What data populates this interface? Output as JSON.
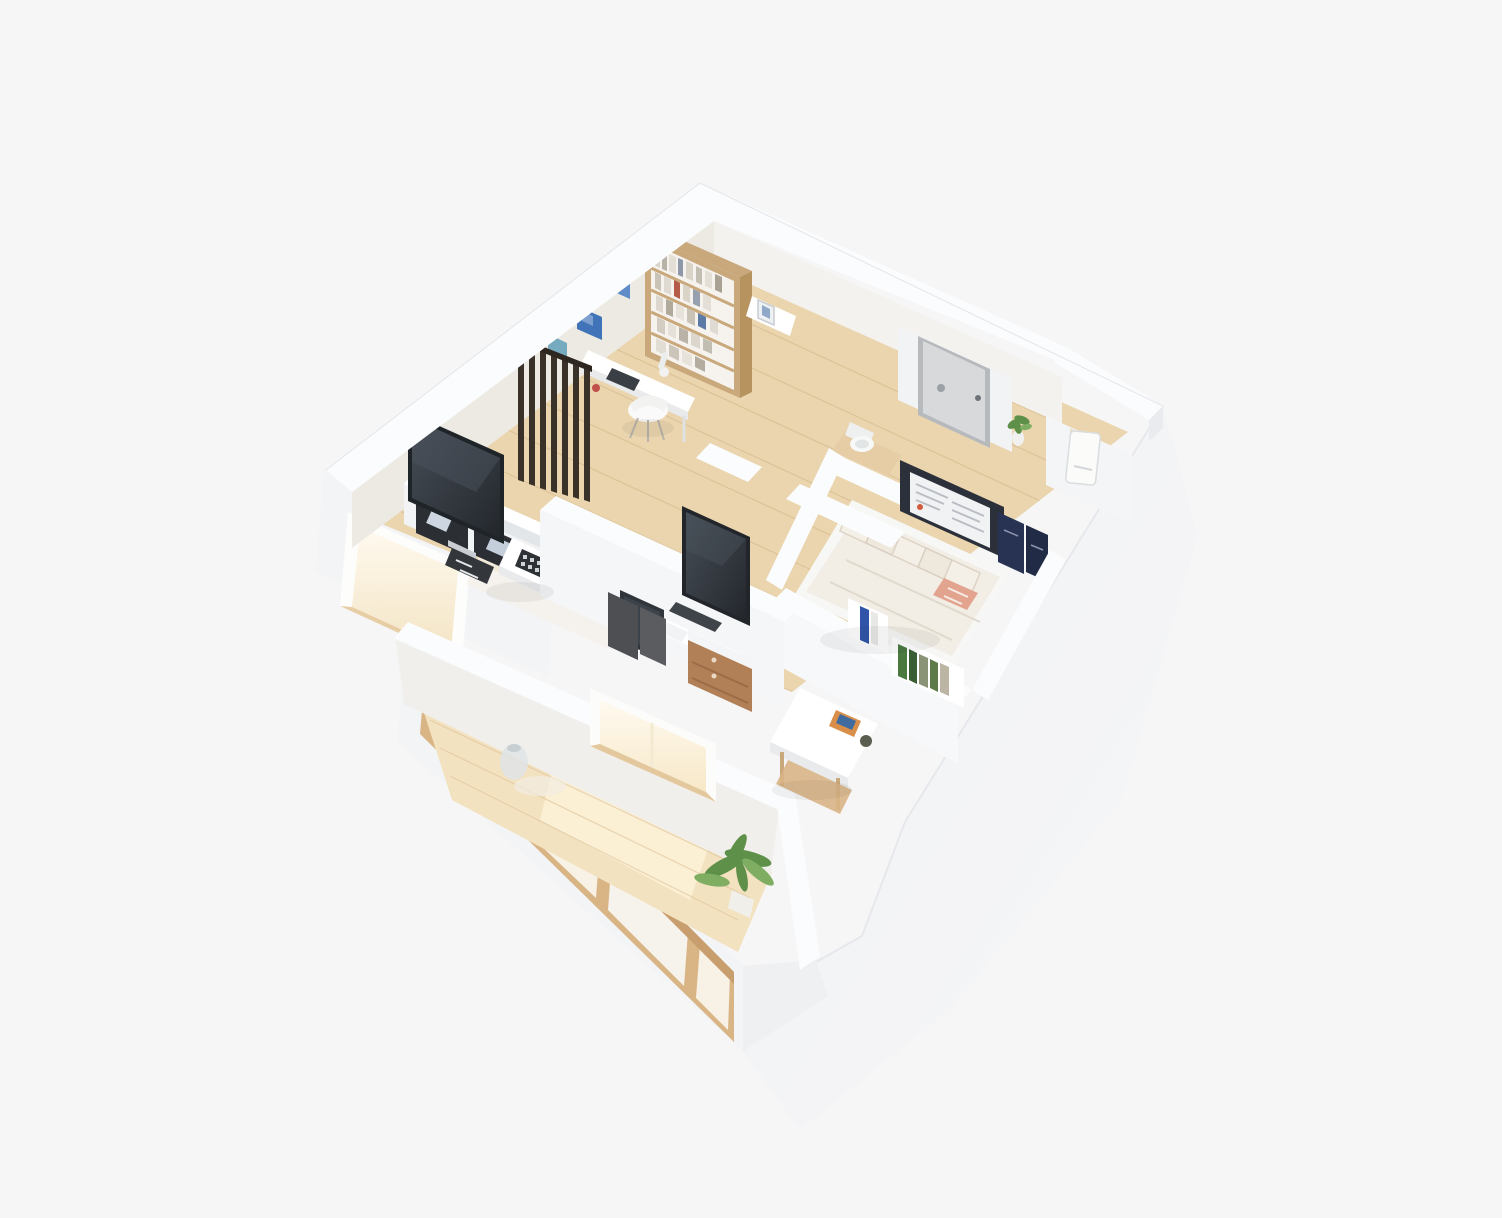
{
  "scene": {
    "type": "3d-isometric-floorplan-render",
    "description": "dollhouse cutaway view of a small apartment on a plain light background",
    "rooms": [
      {
        "name": "study",
        "objects": [
          "bookshelf",
          "wall-desk",
          "desk-chair",
          "wall-art-x3",
          "slat-partition",
          "side-stand"
        ]
      },
      {
        "name": "living-room",
        "objects": [
          "tv",
          "tv-console",
          "soundbar",
          "av-receiver",
          "coffee-table",
          "daybed",
          "rug"
        ]
      },
      {
        "name": "media-hall",
        "objects": [
          "spine-wall-tv",
          "workstation-desk",
          "monitor",
          "keyboard",
          "phone",
          "wood-cabinet",
          "chair-panels"
        ]
      },
      {
        "name": "bedroom",
        "objects": [
          "bed",
          "pillows",
          "accent-cushion",
          "media-panel",
          "navy-books",
          "wall-shelf-books"
        ]
      },
      {
        "name": "entry",
        "objects": [
          "entry-door",
          "toilet",
          "floor-plant",
          "water-heater"
        ]
      },
      {
        "name": "dining-nook",
        "objects": [
          "small-table",
          "table-book",
          "cup",
          "wood-bench"
        ]
      },
      {
        "name": "balcony",
        "objects": [
          "glowing-window",
          "potted-plant",
          "glass-vase",
          "shoji-window-facade"
        ]
      }
    ]
  },
  "palette": {
    "bg": "#f6f6f7",
    "wallTop": "#fbfcfd",
    "bandEdge": "#e3e6e9",
    "wallFace": "#f3f4f6",
    "wallFaceShade": "#e9ebee",
    "wallInnerWarm": "#edeae4",
    "wallInnerLight": "#f4f2ee",
    "floorWood": "#ead5ae",
    "floorWoodDark": "#dfc398",
    "plankLine": "#d3b485",
    "floorBalcony": "#f3e2c0",
    "floorGlow": "#fbefd4",
    "woodFurniture": "#c9a87c",
    "woodSide": "#b6935f",
    "woodCabinet": "#b28057",
    "woodFrame": "#d9b586",
    "dark": "#2e3237",
    "screen": "#3a4049",
    "glass": "#2b2e33",
    "white": "#ffffff",
    "softWhite": "#f6f6f4",
    "artBlue1": "#5f8cc7",
    "artBlue2": "#4173b8",
    "artTeal": "#76aabf",
    "bookBlue": "#2f54a8",
    "bookGreen": "#4a7a40",
    "bookOlive": "#6b7a3f",
    "bookRed": "#c05a44",
    "bookNavy": "#283253",
    "plantGreen": "#5f9049",
    "plantGreenLight": "#7fae62",
    "glow": "#fff4dd",
    "glowBright": "#fffaf0",
    "bedLinen": "#f2ede5",
    "pillowStripe": "#d8cec0",
    "cushionSalmon": "#e2a48e",
    "doorFace": "#d7d9db",
    "doorFrame": "#b7babd",
    "navyPanel": "#2b303a"
  }
}
